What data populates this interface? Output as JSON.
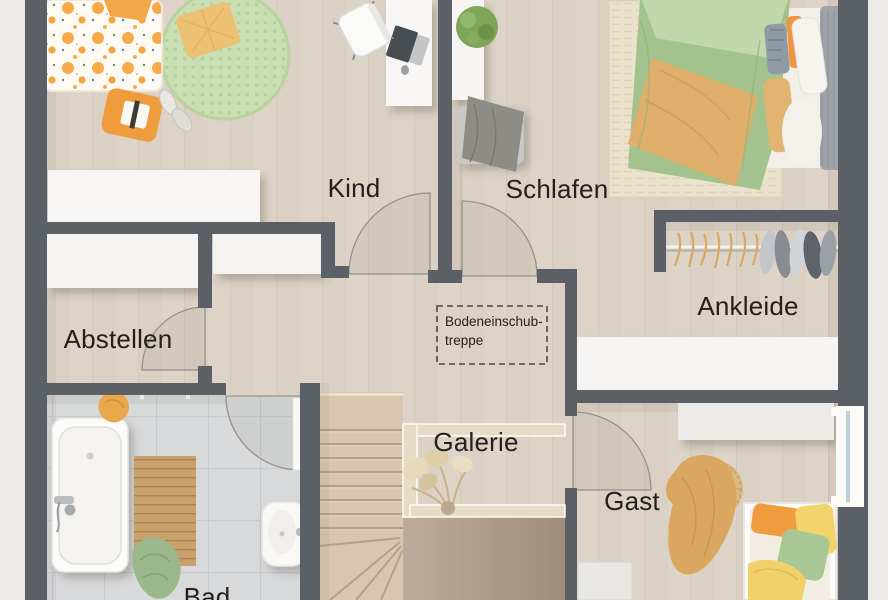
{
  "floorplan": {
    "type": "upper-floor plan (Obergeschoss)",
    "rooms": [
      {
        "id": "kind",
        "label": "Kind"
      },
      {
        "id": "schlafen",
        "label": "Schlafen"
      },
      {
        "id": "abstellen",
        "label": "Abstellen"
      },
      {
        "id": "ankleide",
        "label": "Ankleide"
      },
      {
        "id": "galerie",
        "label": "Galerie"
      },
      {
        "id": "gast",
        "label": "Gast"
      },
      {
        "id": "bad",
        "label": "Bad"
      }
    ],
    "attic_hatch": {
      "line1": "Bodeneinschub-",
      "line2": "treppe"
    },
    "colors": {
      "wall": "#5b6066",
      "floor_wood": "#dcd2c5",
      "floor_tile": "#d7d9da",
      "furniture_white": "#f7f6f4",
      "accent_orange": "#f09d3f",
      "accent_sage": "#a3c28d",
      "accent_tan": "#dcad6b",
      "rug_green": "#c8dfb2",
      "stairs_wood": "#d8c6ae",
      "void_floor": "#b2a08e"
    }
  }
}
